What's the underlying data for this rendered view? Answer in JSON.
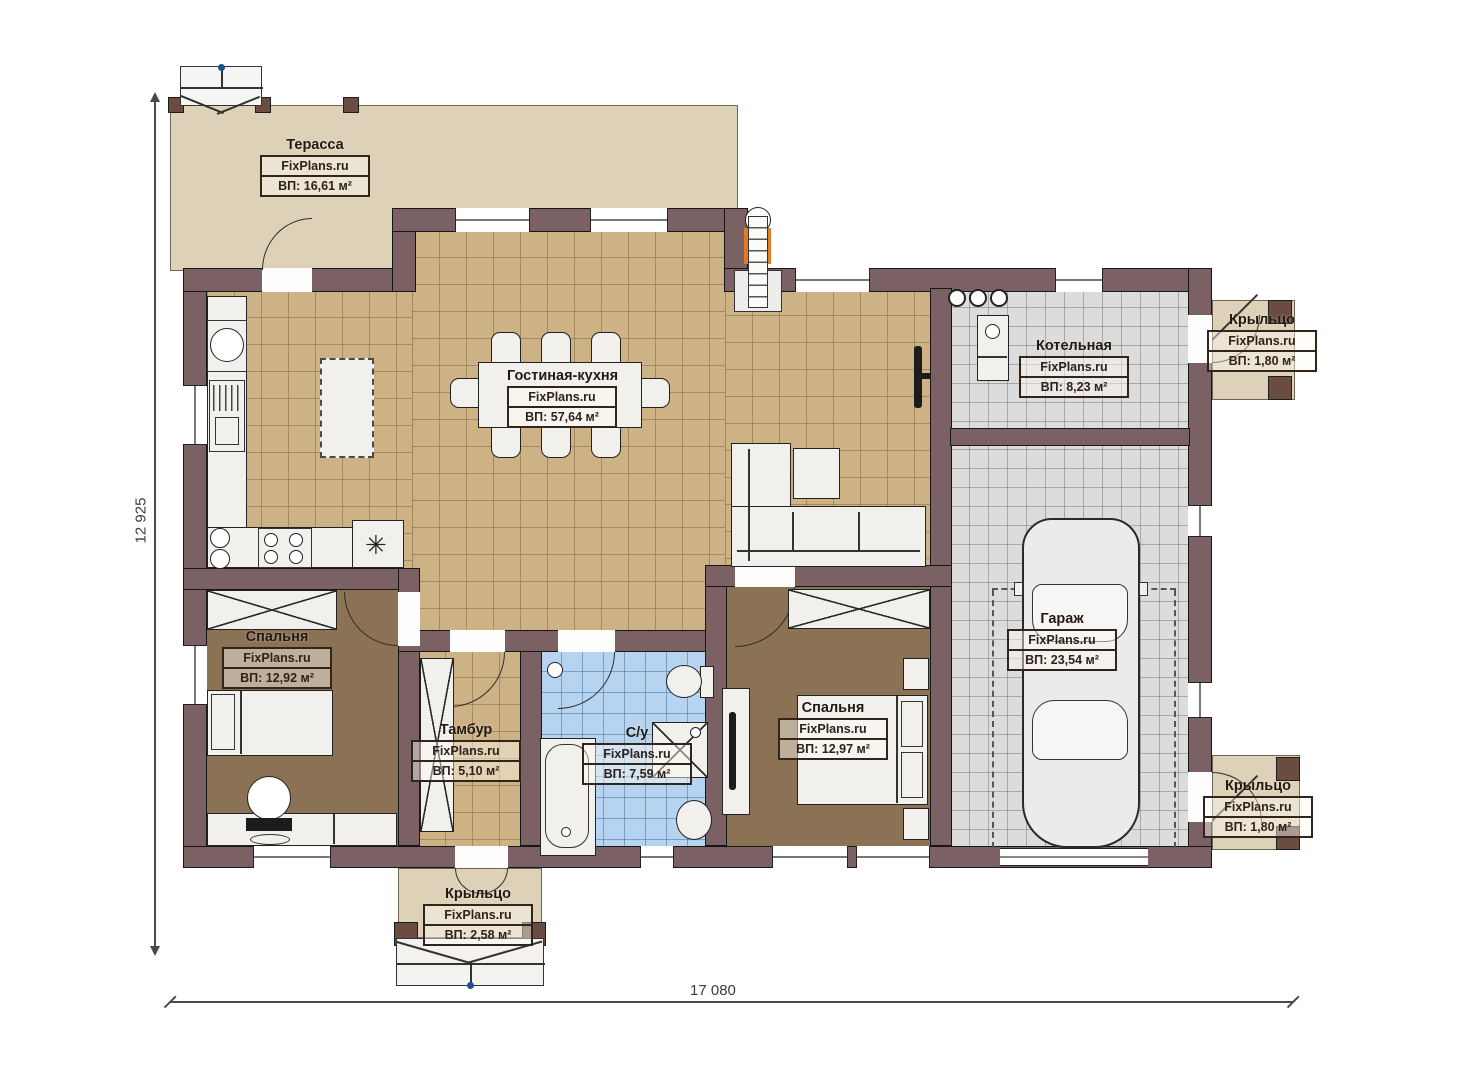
{
  "brand": "FixPlans.ru",
  "rooms": [
    {
      "name": "Терасса",
      "brand": "FixPlans.ru",
      "area": "ВП: 16,61 м²"
    },
    {
      "name": "Гостиная-кухня",
      "brand": "FixPlans.ru",
      "area": "ВП: 57,64 м²"
    },
    {
      "name": "Котельная",
      "brand": "FixPlans.ru",
      "area": "ВП: 8,23 м²"
    },
    {
      "name": "Крыльцо",
      "brand": "FixPlans.ru",
      "area": "ВП: 1,80 м²"
    },
    {
      "name": "Спальня",
      "brand": "FixPlans.ru",
      "area": "ВП: 12,92 м²"
    },
    {
      "name": "Тамбур",
      "brand": "FixPlans.ru",
      "area": "ВП: 5,10 м²"
    },
    {
      "name": "С/у",
      "brand": "FixPlans.ru",
      "area": "ВП: 7,59 м²"
    },
    {
      "name": "Спальня",
      "brand": "FixPlans.ru",
      "area": "ВП: 12,97 м²"
    },
    {
      "name": "Гараж",
      "brand": "FixPlans.ru",
      "area": "ВП: 23,54 м²"
    },
    {
      "name": "Крыльцо",
      "brand": "FixPlans.ru",
      "area": "ВП: 1,80 м²"
    },
    {
      "name": "Крыльцо",
      "brand": "FixPlans.ru",
      "area": "ВП: 2,58 м²"
    }
  ],
  "dimensions": {
    "height": "12 925",
    "width": "17 080"
  },
  "colors": {
    "wall": "#7b6164",
    "floor_living": "#ccb285",
    "floor_bedroom": "#8b7255",
    "floor_bathroom": "#b6d4f0",
    "floor_garage": "#dcdcdc",
    "terrace": "#ddd1b8",
    "chimney_accent": "#e07b28"
  }
}
